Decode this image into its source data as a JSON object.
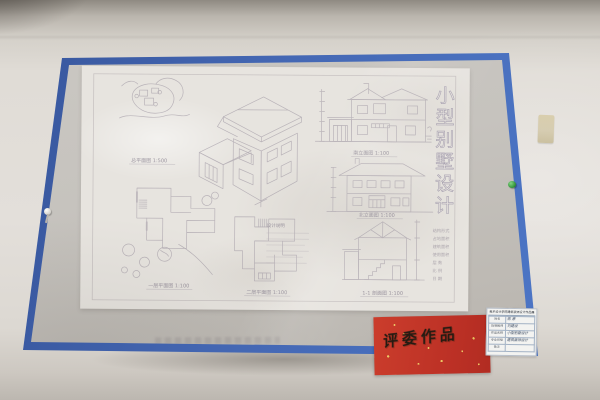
{
  "artwork": {
    "title": "小型别墅设计",
    "title_chars": [
      "小",
      "型",
      "别",
      "墅",
      "设",
      "计"
    ],
    "labels": {
      "site_plan": "总平面图 1:500",
      "floor1": "一层平面图 1:100",
      "floor2": "二层平面图 1:100",
      "elevation_south": "南立面图 1:100",
      "elevation_north": "北立面图 1:100",
      "section": "1-1 剖面图 1:100",
      "notes": "设计说明"
    },
    "spec_lines": [
      "结构形式",
      "占地面积",
      "建筑面积",
      "使用面积",
      "层  数",
      "比  例",
      "日  期"
    ]
  },
  "red_card": {
    "text": "评委作品"
  },
  "label_card": {
    "header": "美术设计学院建筑装饰设计作品展",
    "rows": [
      {
        "label": "姓名",
        "value": "陈 原"
      },
      {
        "label": "指导教师",
        "value": "刘建设"
      },
      {
        "label": "作品名称",
        "value": "小型别墅设计"
      },
      {
        "label": "专业班级",
        "value": "建筑装饰设计"
      },
      {
        "label": "备注",
        "value": ""
      }
    ]
  },
  "colors": {
    "frame_blue": "#4468b3",
    "mat_gray": "#c6c3be",
    "paper": "#e7e4df",
    "pencil": "#9d95a1",
    "wall": "#e0dcd6",
    "red_card": "#bb3025",
    "gold_fleck": "#e8c35e",
    "pin_green": "#2e8f33"
  }
}
